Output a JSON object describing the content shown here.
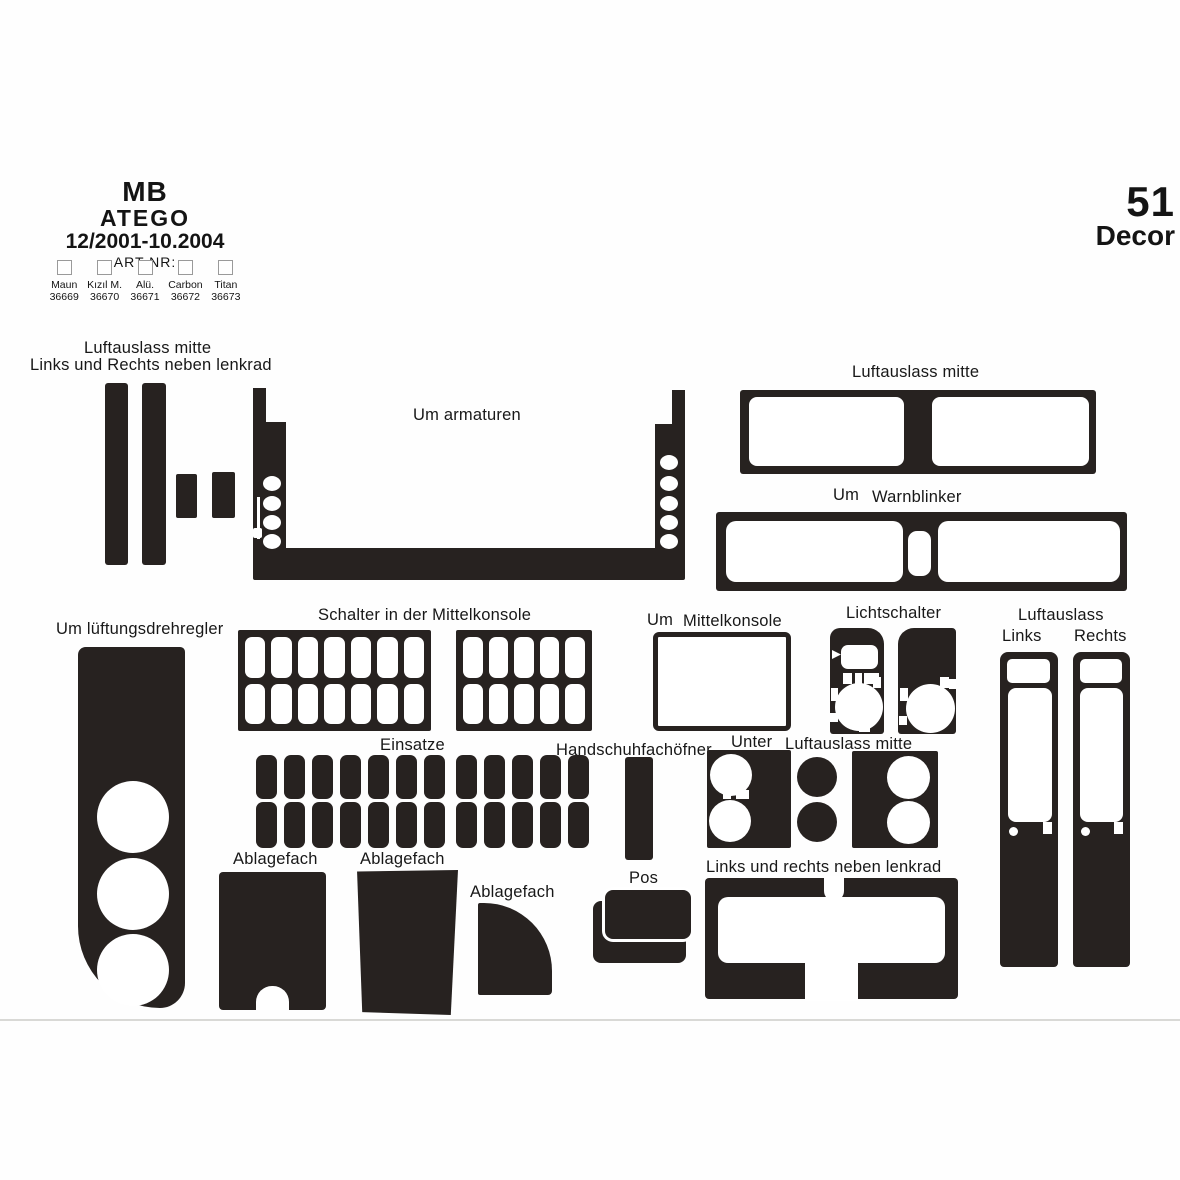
{
  "colors": {
    "piece": "#272220",
    "text": "#181818",
    "divider": "#d9d9d6"
  },
  "header": {
    "brand": "MB",
    "model": "ATEGO",
    "years": "12/2001-10.2004",
    "art_nr_label": "ART NR:",
    "finishes": [
      {
        "name": "Maun",
        "code": "36669"
      },
      {
        "name": "Kızıl M.",
        "code": "36670"
      },
      {
        "name": "Alü.",
        "code": "36671"
      },
      {
        "name": "Carbon",
        "code": "36672"
      },
      {
        "name": "Titan",
        "code": "36673"
      }
    ]
  },
  "badge": {
    "count": "51",
    "label": "Decor"
  },
  "labels": {
    "air_vent_center_top_left": "Luftauslass mitte",
    "left_right_next_to_steering": "Links und Rechts neben lenkrad",
    "around_instruments": "Um armaturen",
    "air_vent_center_right": "Luftauslass mitte",
    "around_warn": "Um",
    "hazard_switch": "Warnblinker",
    "switches_center_console": "Schalter in der Mittelkonsole",
    "around_console": "Um",
    "center_console": "Mittelkonsole",
    "light_switch": "Lichtschalter",
    "air_vent": "Luftauslass",
    "left": "Links",
    "right": "Rechts",
    "around_vent_dial": "Um lüftungsdrehregler",
    "inserts": "Einsatze",
    "glovebox_opener": "Handschuhfachöfner",
    "under": "Unter",
    "air_vent_center_under": "Luftauslass mitte",
    "storage1": "Ablagefach",
    "storage2": "Ablagefach",
    "storage3": "Ablagefach",
    "pos": "Pos",
    "left_right_steering_bottom": "Links und rechts neben lenkrad"
  },
  "grids": {
    "schalter_left": {
      "cols": 7,
      "rows": 2
    },
    "schalter_right": {
      "cols": 5,
      "rows": 2
    },
    "einsatze": {
      "cols": 12,
      "rows": 2
    }
  }
}
